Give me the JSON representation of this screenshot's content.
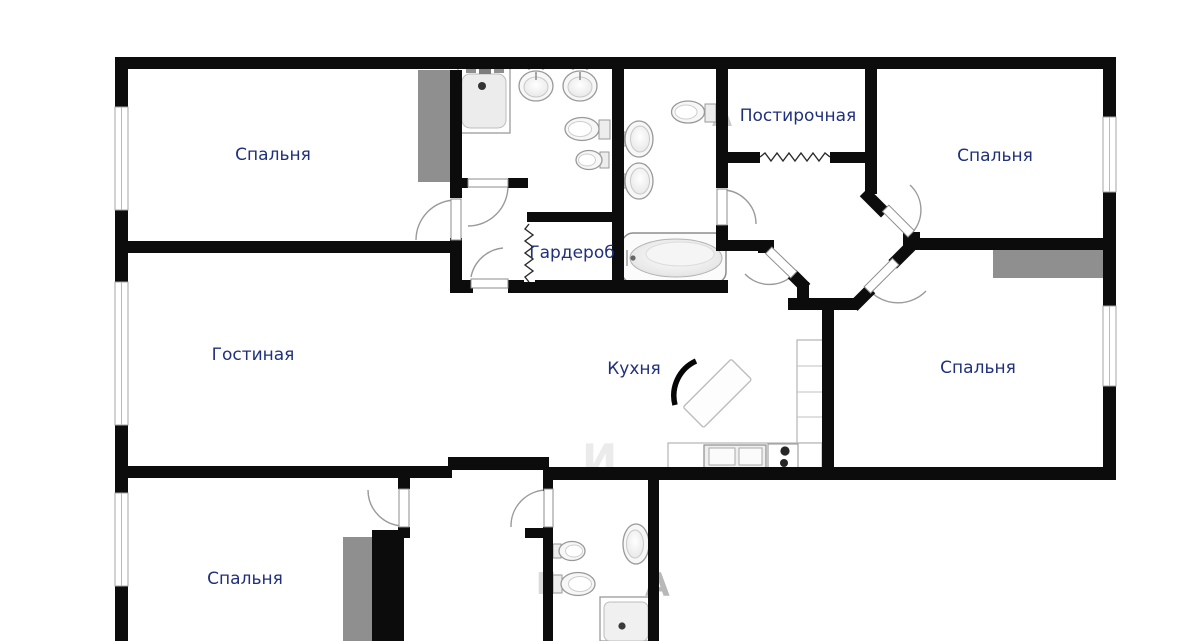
{
  "plan": {
    "type": "apartment-floor-plan",
    "rooms": [
      {
        "id": "bedroom-top-left",
        "label": "Спальня"
      },
      {
        "id": "laundry",
        "label": "Постирочная"
      },
      {
        "id": "bedroom-top-right",
        "label": "Спальня"
      },
      {
        "id": "wardrobe",
        "label": "Гардероб"
      },
      {
        "id": "living-room",
        "label": "Гостиная"
      },
      {
        "id": "kitchen",
        "label": "Кухня"
      },
      {
        "id": "bedroom-middle-right",
        "label": "Спальня"
      },
      {
        "id": "bedroom-bottom-left",
        "label": "Спальня"
      }
    ],
    "watermark": [
      {
        "ch": "А"
      },
      {
        "ch": "Е"
      },
      {
        "ch": "А"
      },
      {
        "ch": "И"
      }
    ],
    "colors": {
      "wall": "#0c0c0c",
      "label": "#21307d",
      "wardrobe_fill": "#8f8f8f",
      "fixture_stroke": "#999999",
      "door_arc": "#9a9a9a",
      "background": "#ffffff"
    },
    "icons": [
      "window-icon",
      "door-swing-icon",
      "accordion-door-icon",
      "wardrobe-icon",
      "shower-tray-icon",
      "sink-icon",
      "toilet-icon",
      "bidet-icon",
      "bathtub-icon",
      "kitchen-counter-icon",
      "stove-icon",
      "kitchen-island-icon"
    ]
  }
}
